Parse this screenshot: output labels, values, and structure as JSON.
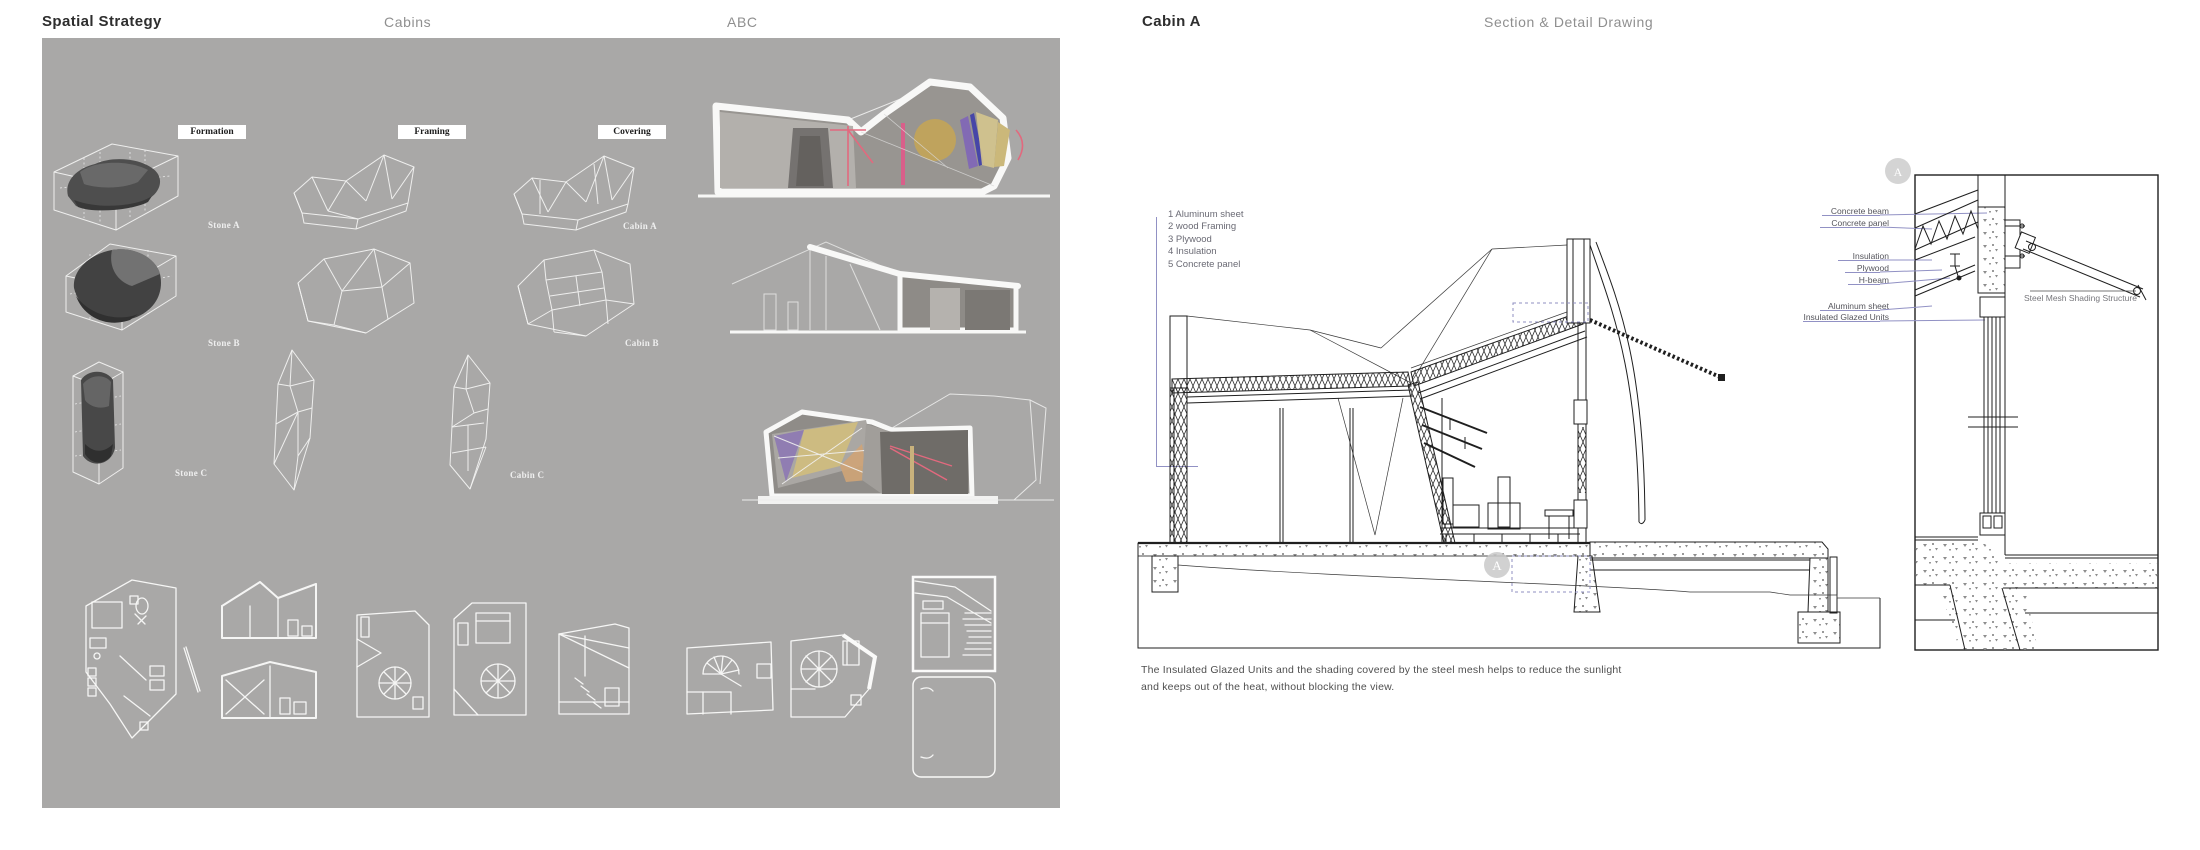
{
  "left_panel": {
    "title": "Spatial Strategy",
    "header_center": "Cabins",
    "header_right": "ABC",
    "panel_bg": "#a9a8a7",
    "column_labels": {
      "formation": "Formation",
      "framing": "Framing",
      "covering": "Covering"
    },
    "rows": [
      {
        "stone": "Stone A",
        "cabin": "Cabin A"
      },
      {
        "stone": "Stone B",
        "cabin": "Cabin B"
      },
      {
        "stone": "Stone C",
        "cabin": "Cabin C"
      }
    ]
  },
  "right_panel": {
    "title": "Cabin A",
    "subtitle": "Section & Detail Drawing",
    "material_list": [
      "1 Aluminum sheet",
      "2 wood Framing",
      "3 Plywood",
      "4 Insulation",
      "5 Concrete panel"
    ],
    "detail_labels": [
      "Concrete beam",
      "Concrete panel",
      "Insulation",
      "Plywood",
      "H-beam",
      "Aluminum sheet",
      "Insulated Glazed Units"
    ],
    "detail_inner_label": "Steel Mesh Shading Structure",
    "callout_letter": "A",
    "caption_line1": "The Insulated Glazed Units and the shading covered by the steel mesh helps to reduce the sunlight",
    "caption_line2": "and keeps out of the heat, without blocking the view.",
    "colors": {
      "leader": "#9191c4",
      "drawing_line": "#1f1f1f",
      "callout_fill": "#c9c9c9",
      "caption_text": "#4f4f4f"
    }
  }
}
